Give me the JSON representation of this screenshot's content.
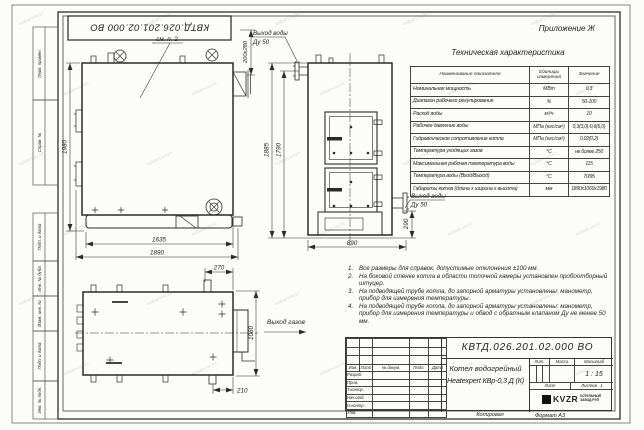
{
  "colors": {
    "paper": "#fcfcfa",
    "ink": "#2b2b2b"
  },
  "meta": {
    "appendix": "Приложение Ж",
    "doc_number": "КВТД.026.201.02.000 ВО",
    "copied_label": "Копировал",
    "format_label": "Формат А3",
    "watermark": "kotlam-kv.kz"
  },
  "frame_stamps": {
    "s1": "Перв. примен.",
    "s2": "Справ. №",
    "s3": "Подп. и дата",
    "s4": "Инв. № дубл.",
    "s5": "Взам. инв. №",
    "s6": "Подп. и дата",
    "s7": "Инв. № подл."
  },
  "spec_table": {
    "title": "Техническая характеристика",
    "col_name": "Наименование показателя",
    "col_units": "Единицы измерения",
    "col_value": "Значение",
    "rows": [
      {
        "name": "Номинальная мощность",
        "units": "МВт",
        "value": "0,3"
      },
      {
        "name": "Диапазон рабочего регулирования",
        "units": "%",
        "value": "50-100"
      },
      {
        "name": "Расход воды",
        "units": "м³/ч",
        "value": "10"
      },
      {
        "name": "Рабочее давление воды",
        "units": "МПа (кгс/см²)",
        "value": "0,3(3,0)-0,6(6,0)"
      },
      {
        "name": "Гидравлическое сопротивление котла",
        "units": "МПа (кгс/см²)",
        "value": "0,02(0,2)"
      },
      {
        "name": "Температура уходящих газов",
        "units": "°С",
        "value": "не более 250"
      },
      {
        "name": "Максимальная рабочая температура воды",
        "units": "°С",
        "value": "115"
      },
      {
        "name": "Температура воды (Вход/Выход)",
        "units": "°С",
        "value": "70/95"
      },
      {
        "name": "Габариты котла (длина х ширина х высота)",
        "units": "мм",
        "value": "1890х1060х1980"
      }
    ]
  },
  "notes": {
    "items": [
      {
        "num": "1.",
        "text": "Все размеры для справок, допустимые отклонения ±100 мм."
      },
      {
        "num": "2.",
        "text": "На боковой стенке котла в области топочной камеры установлен пробоотборный штуцер."
      },
      {
        "num": "3.",
        "text": "На подводящей трубе котла, до запорной арматуры установлены: манометр, прибор для измерения температуры."
      },
      {
        "num": "4.",
        "text": "На подводящей трубе котла, до запорной арматуры установлены: манометр, прибор для измерения температуры и обвод с обратным клапаном Ду не менее 50 мм."
      }
    ]
  },
  "views": {
    "side": {
      "callout": "см. п. 2",
      "dim_height": "1980",
      "dim_inner": "1635",
      "dim_length": "1890",
      "dim_flue": "200х280"
    },
    "front": {
      "out_top_1": "Выход воды",
      "out_top_2": "Ду 50",
      "out_right_1": "Выход воды",
      "out_right_2": "Ду 50",
      "dim_h1": "1885",
      "dim_h2": "1790",
      "dim_w": "890",
      "dim_off": "290"
    },
    "top": {
      "gas_label": "Выход газов",
      "dim_flue_off": "270",
      "dim_depth": "1060",
      "dim_bottom": "210"
    }
  },
  "title_block": {
    "designation": "КВТД.026.201.02.000 ВО",
    "name_line1": "Котел водогрейный",
    "name_line2": "Heatexpert КВр-0,3 Д (К)",
    "cols": {
      "izm": "Изм.",
      "list": "Лист",
      "doc": "№ докум.",
      "podp": "Подп.",
      "data": "Дата"
    },
    "roles": [
      "Разраб.",
      "Пров.",
      "Т.контр.",
      "Нач.отд.",
      "Н.контр.",
      "Утв."
    ],
    "lit_label": "Лит.",
    "mass_label": "Масса",
    "scale_label": "Масштаб",
    "scale_value": "1 : 15",
    "sheet_label": "Лист",
    "sheets_label": "Листов",
    "sheets_value": "1",
    "logo_text": "KVZR",
    "logo_line1": "КОТЕЛЬНЫЙ",
    "logo_line2": "ЗАВОД РЭП"
  }
}
